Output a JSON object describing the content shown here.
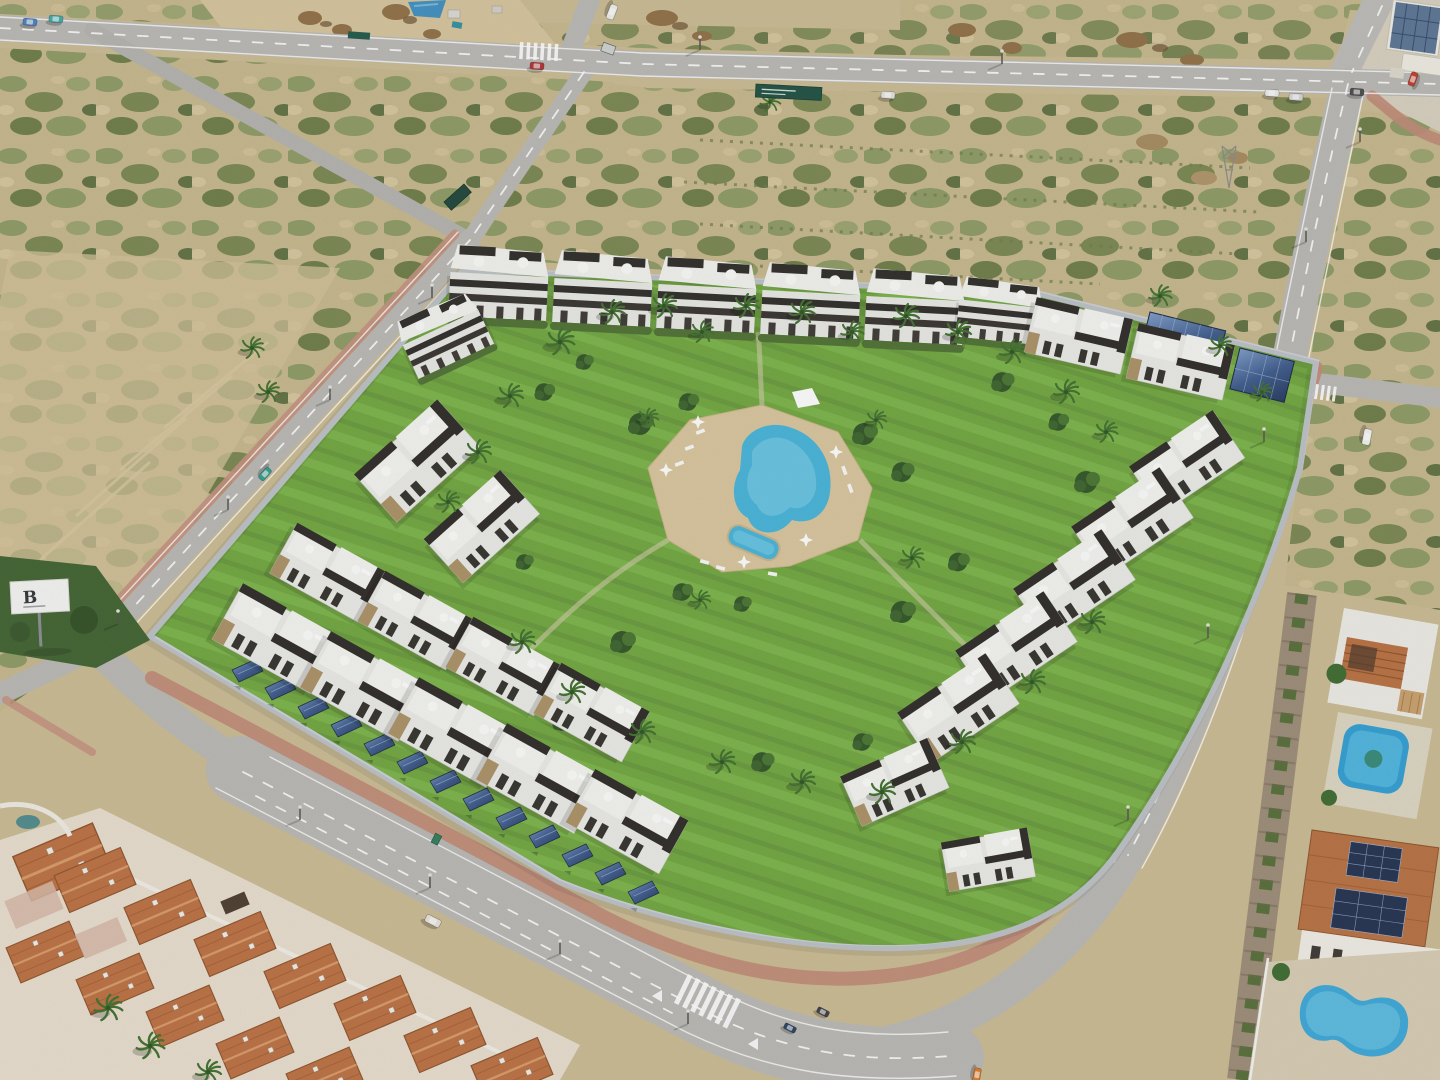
{
  "meta": {
    "title": "Aerial 3D render of a new-build residential complex beside older terracotta-roof houses and empty scrubland plots",
    "view": "high oblique aerial, afternoon sun from the east"
  },
  "sign": {
    "letter": "B"
  },
  "palette": {
    "sand": "#cbbb92",
    "scrub_olive": "#87925c",
    "scrub_dark": "#5f7040",
    "road": "#b9b8b4",
    "road_marking": "#ffffff",
    "sidewalk_pink": "#c08a76",
    "lawn": "#6fa63d",
    "pool_water": "#45b4da",
    "pool_deck": "#d9c69c",
    "building_white": "#f0efec",
    "building_dark": "#2b2824",
    "stone_accent": "#ad9266",
    "solar_panel": "#3c5a8c",
    "terracotta_roof": "#bc6e3f",
    "perimeter_wall": "#ccd1d7",
    "stone_wall": "#9b8c76",
    "vegetation": "#3c6a2e"
  },
  "inventory": {
    "apartment_blocks": 26,
    "palm_trees": 36,
    "solar_carport_panels": 18,
    "rooftop_solar_arrays": 4,
    "vehicles": 15,
    "pools": [
      "resort pool",
      "kids pool",
      "private rectangular pool",
      "private kidney pool"
    ],
    "crosswalks": 4,
    "billboard": 1
  }
}
